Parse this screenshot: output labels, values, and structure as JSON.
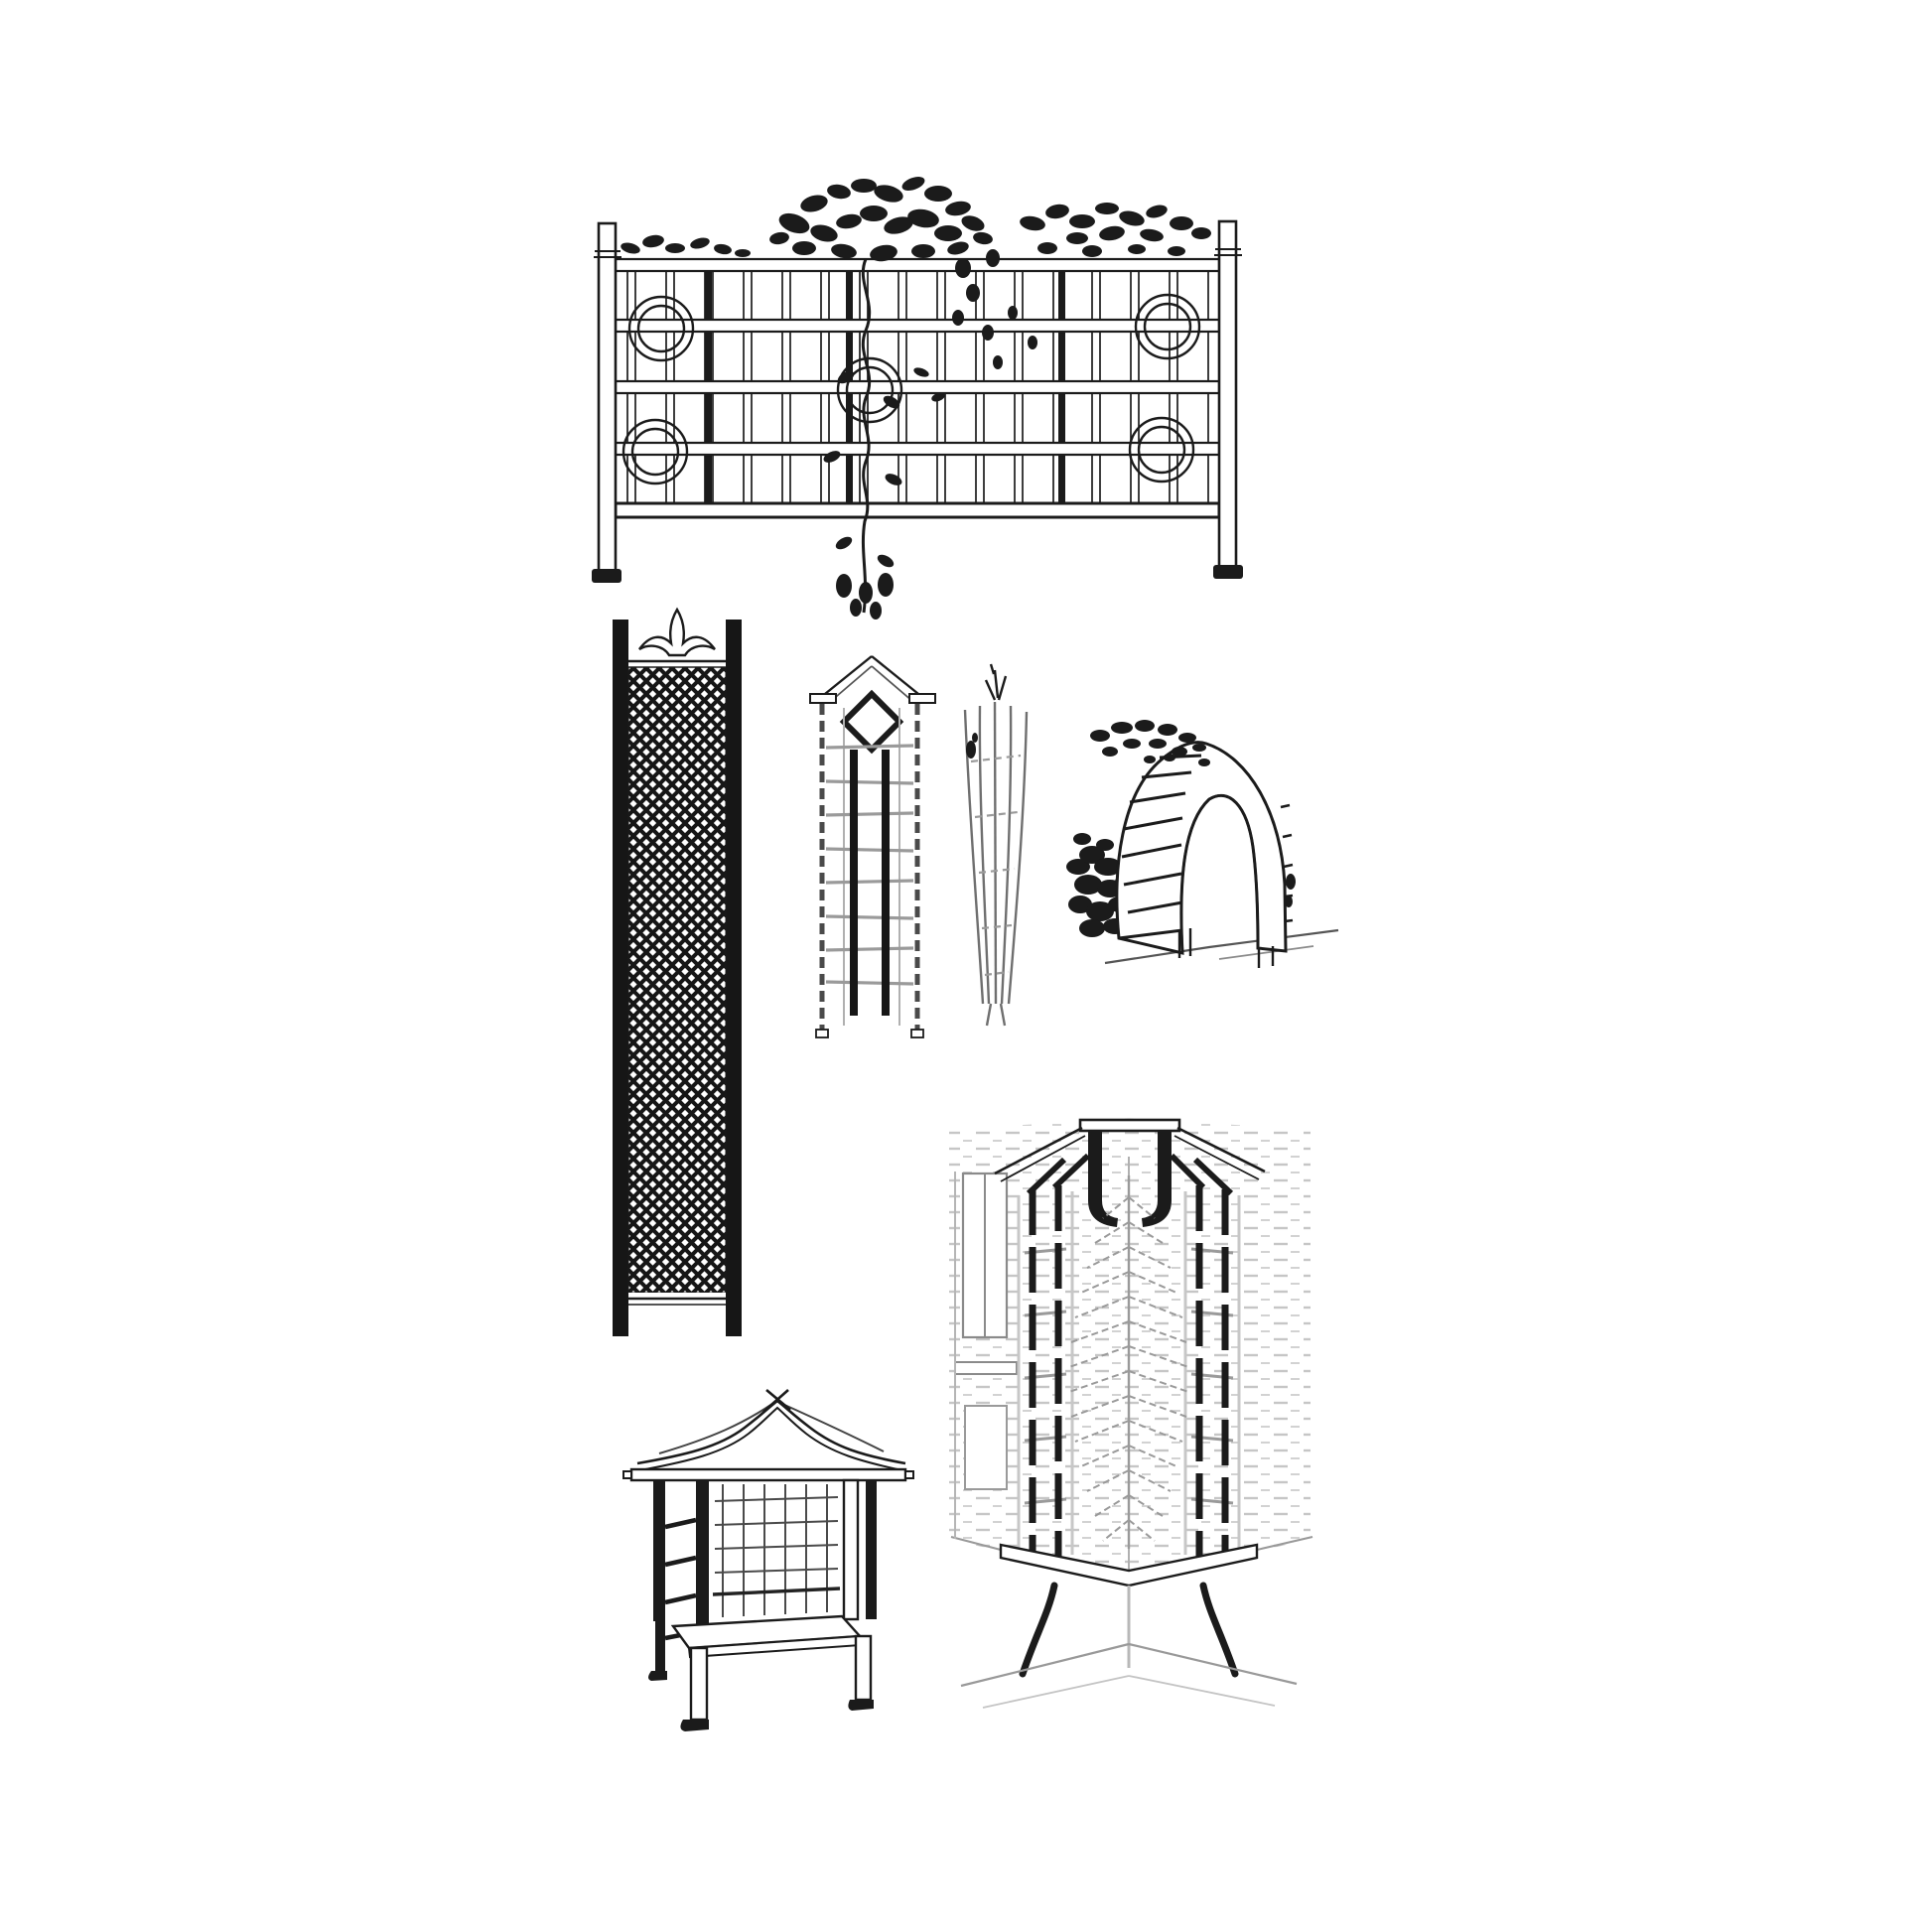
{
  "page": {
    "kind": "black-and-white line-art illustration sheet",
    "subject": "garden trellis and arbour designs",
    "background_color": "#ffffff",
    "ink_color": "#1b1b1b",
    "pencil_color": "#8a8a8a",
    "light_pencil_color": "#b5b5b5",
    "brick_hatch_color": "#c6c6c6"
  },
  "figures": [
    {
      "id": "trellis-fence-panel",
      "label": "Wide trellis fence panel with two capped end posts, five horizontal rails, a square grid of slats, circle medallions and a climbing vine spilling over the top"
    },
    {
      "id": "lattice-pilaster-panel",
      "label": "Tall narrow trellis panel with solid side posts, dense diagonal lattice infill and a fleur-de-lis style crest on top"
    },
    {
      "id": "ladder-trellis-diamond",
      "label": "Slim ladder trellis with pointed gable top, diamond motif and two dark centre battens"
    },
    {
      "id": "fan-trellis",
      "label": "Slender tapered fan trellis, narrow at the base and spreading toward the top"
    },
    {
      "id": "arch-trellis",
      "label": "Round-top arch trellis with ladder rungs seen in perspective, with a climbing shrub at its left"
    },
    {
      "id": "arbor-bench",
      "label": "Garden arbour seat with swept gable roof, lattice back and sides, bench seat and four legs"
    },
    {
      "id": "corner-trellis-seat",
      "label": "Corner trellis seat set against brick walls, with a roof cap, two segmented trellis ladders, a fern in the corner and a bench with curved legs"
    }
  ]
}
